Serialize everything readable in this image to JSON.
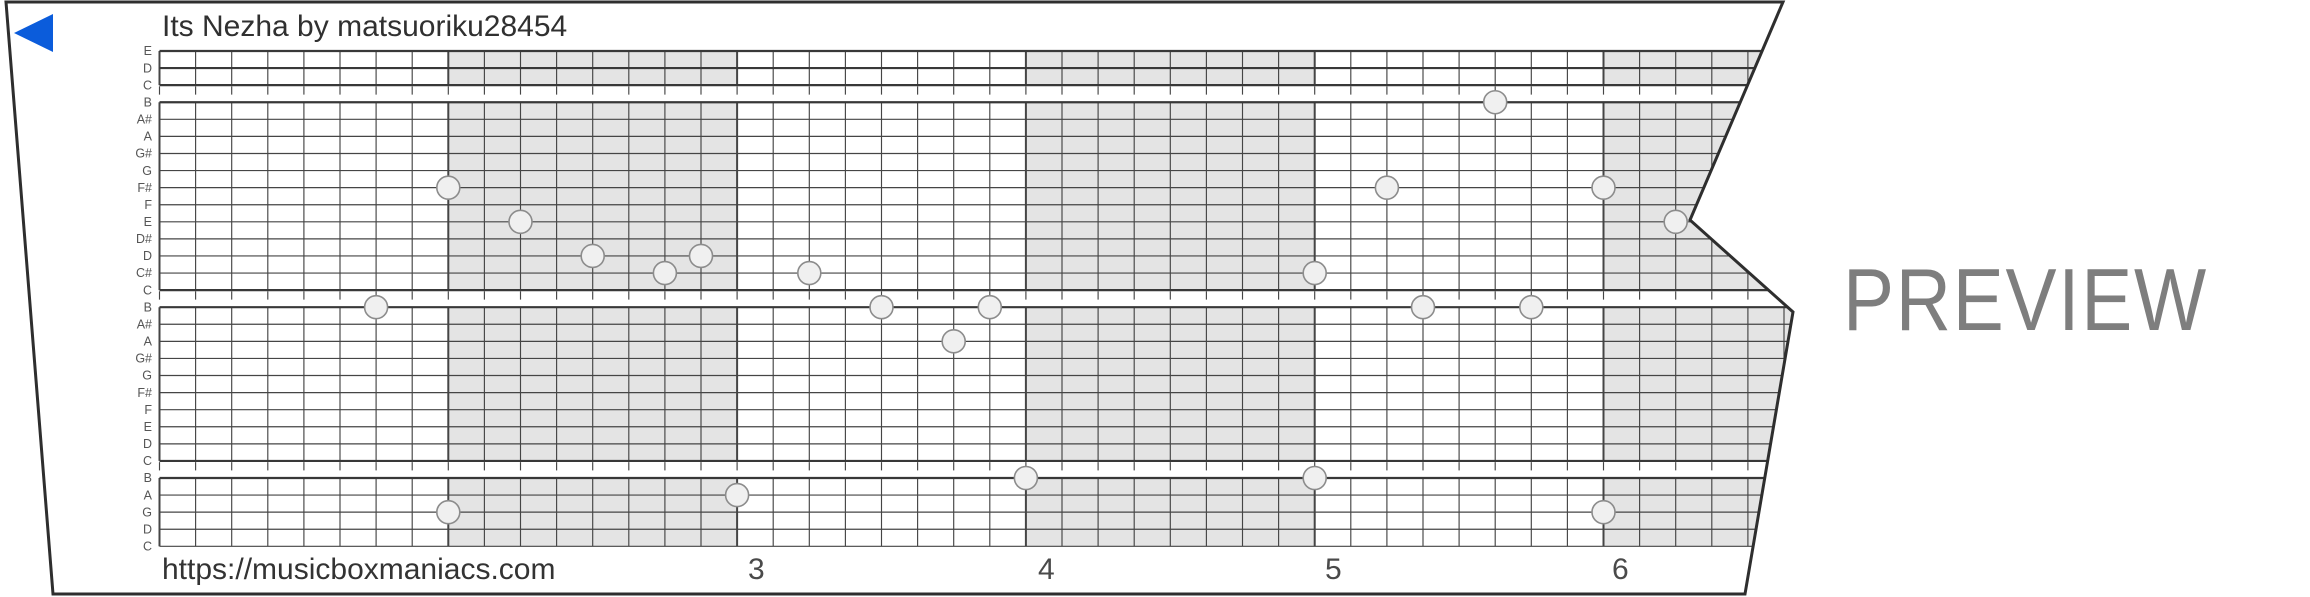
{
  "header": {
    "title": "Its Nezha by matsuoriku28454"
  },
  "footer": {
    "url": "https://musicboxmaniacs.com"
  },
  "watermark": "PREVIEW",
  "icons": {
    "direction_arrow": "left-triangle-icon"
  },
  "colors": {
    "strip_border": "#2e2e2e",
    "grid_line": "#454545",
    "grid_line_strong": "#383838",
    "measure_shading": "#e4e4e4",
    "note_fill": "#f0f0f0",
    "note_stroke": "#8c8c8c",
    "label_text": "#555555",
    "title_text": "#303030",
    "footer_text": "#333333",
    "measure_number_text": "#4a4a4a",
    "watermark_text": "#7e7e7e",
    "arrow_blue": "#0b5cdb",
    "background": "#ffffff"
  },
  "strip_outline_points": [
    [
      6,
      2
    ],
    [
      1783,
      2
    ],
    [
      1690,
      220
    ],
    [
      1793,
      312
    ],
    [
      1745,
      594
    ],
    [
      53,
      594
    ]
  ],
  "grid": {
    "x0": 159.5,
    "col_width": 36.1,
    "num_cols": 45,
    "y0": 51,
    "row_spacing": 17.08,
    "num_rows": 30,
    "cols_per_measure": 8,
    "shaded_measures": [
      2,
      4,
      6
    ],
    "octave_gap_after_rows": [
      2,
      14,
      24
    ],
    "strong_rows": [
      0,
      1,
      2,
      3,
      14,
      15,
      24,
      25
    ],
    "right_extent": 1810,
    "note_radius": 11.5
  },
  "row_labels": [
    "E",
    "D",
    "C",
    "B",
    "A#",
    "A",
    "G#",
    "G",
    "F#",
    "F",
    "E",
    "D#",
    "D",
    "C#",
    "C",
    "B",
    "A#",
    "A",
    "G#",
    "G",
    "F#",
    "F",
    "E",
    "D",
    "C",
    "B",
    "A",
    "G",
    "D",
    "C"
  ],
  "measure_numbers": [
    {
      "label": "3",
      "x": 748
    },
    {
      "label": "4",
      "x": 1038
    },
    {
      "label": "5",
      "x": 1325
    },
    {
      "label": "6",
      "x": 1612
    }
  ],
  "chart_data": {
    "type": "piano-roll",
    "time_unit": "eighth-note columns, 8 per measure",
    "pitch_rows_top_to_bottom": [
      "E6",
      "D6",
      "C6",
      "B5",
      "A#5",
      "A5",
      "G#5",
      "G5",
      "F#5",
      "F5",
      "E5",
      "D#5",
      "D5",
      "C#5",
      "C5",
      "B4",
      "A#4",
      "A4",
      "G#4",
      "G4",
      "F#4",
      "F4",
      "E4",
      "D4",
      "C4",
      "B3",
      "A3",
      "G3",
      "D3",
      "C3"
    ],
    "notes": [
      {
        "col": 6,
        "row": 15,
        "pitch": "B4"
      },
      {
        "col": 8,
        "row": 8,
        "pitch": "F#5"
      },
      {
        "col": 8,
        "row": 27,
        "pitch": "G3"
      },
      {
        "col": 10,
        "row": 10,
        "pitch": "E5"
      },
      {
        "col": 12,
        "row": 12,
        "pitch": "D5"
      },
      {
        "col": 14,
        "row": 13,
        "pitch": "C#5"
      },
      {
        "col": 15,
        "row": 12,
        "pitch": "D5"
      },
      {
        "col": 16,
        "row": 26,
        "pitch": "A3"
      },
      {
        "col": 18,
        "row": 13,
        "pitch": "C#5"
      },
      {
        "col": 20,
        "row": 15,
        "pitch": "B4"
      },
      {
        "col": 22,
        "row": 17,
        "pitch": "A4"
      },
      {
        "col": 23,
        "row": 15,
        "pitch": "B4"
      },
      {
        "col": 24,
        "row": 25,
        "pitch": "B3"
      },
      {
        "col": 32,
        "row": 13,
        "pitch": "C#5"
      },
      {
        "col": 32,
        "row": 25,
        "pitch": "B3"
      },
      {
        "col": 34,
        "row": 8,
        "pitch": "F#5"
      },
      {
        "col": 35,
        "row": 15,
        "pitch": "B4"
      },
      {
        "col": 37,
        "row": 3,
        "pitch": "B5"
      },
      {
        "col": 38,
        "row": 15,
        "pitch": "B4"
      },
      {
        "col": 40,
        "row": 8,
        "pitch": "F#5"
      },
      {
        "col": 40,
        "row": 27,
        "pitch": "G3"
      },
      {
        "col": 42,
        "row": 10,
        "pitch": "E5"
      }
    ]
  }
}
